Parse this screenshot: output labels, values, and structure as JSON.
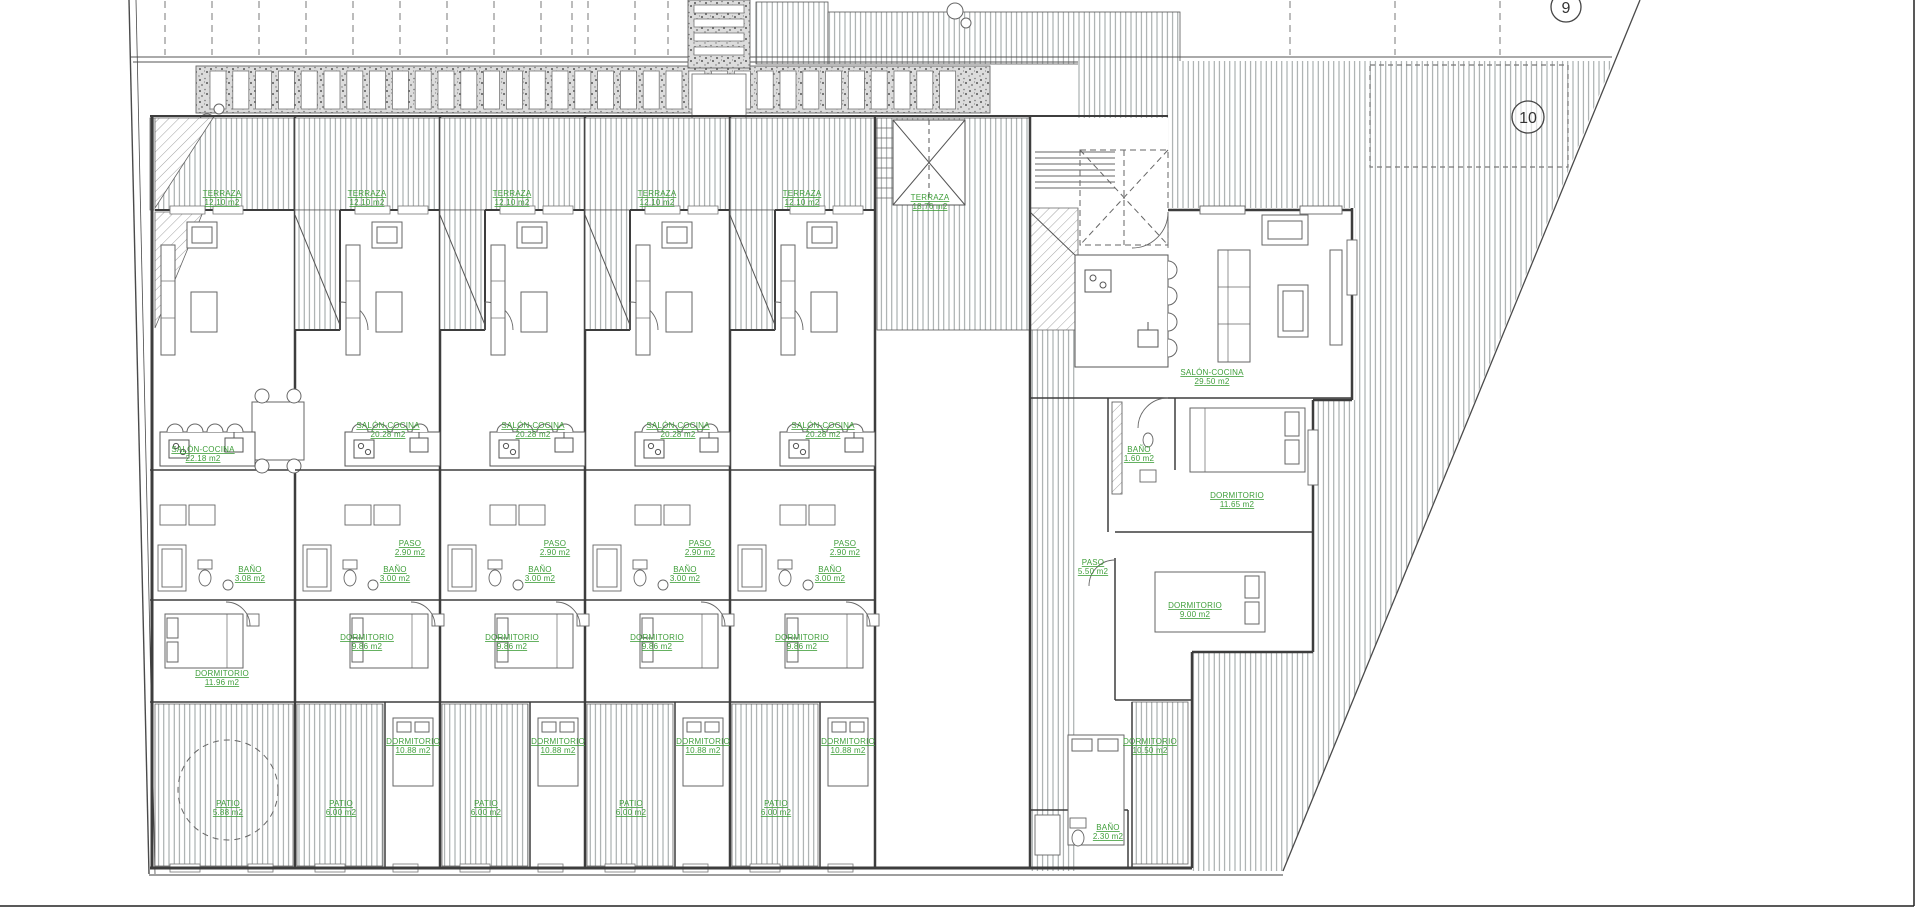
{
  "drawing": {
    "type": "architectural-floor-plan",
    "colors": {
      "label_green": "#3f9e3a",
      "line_dark": "#3d3d3d",
      "hatch_gray": "#9aa0a0"
    }
  },
  "plots": [
    {
      "number": "9"
    },
    {
      "number": "10"
    }
  ],
  "units": [
    {
      "id": "unit-1",
      "labels": {
        "terraza": {
          "name": "TERRAZA",
          "area": "12.10 m2"
        },
        "salon": {
          "name": "SALÓN-COCINA",
          "area": "22.18 m2"
        },
        "bano": {
          "name": "BAÑO",
          "area": "3.08 m2"
        },
        "dorm1": {
          "name": "DORMITORIO",
          "area": "11.96 m2"
        },
        "patio": {
          "name": "PATIO",
          "area": "5.88 m2"
        }
      }
    },
    {
      "id": "unit-2",
      "labels": {
        "terraza": {
          "name": "TERRAZA",
          "area": "12.10 m2"
        },
        "salon": {
          "name": "SALÓN-COCINA",
          "area": "20.28 m2"
        },
        "paso": {
          "name": "PASO",
          "area": "2.90 m2"
        },
        "bano": {
          "name": "BAÑO",
          "area": "3.00 m2"
        },
        "dorm1": {
          "name": "DORMITORIO",
          "area": "9.86 m2"
        },
        "dorm2": {
          "name": "DORMITORIO",
          "area": "10.88 m2"
        },
        "patio": {
          "name": "PATIO",
          "area": "6.00 m2"
        }
      }
    },
    {
      "id": "unit-3",
      "labels": {
        "terraza": {
          "name": "TERRAZA",
          "area": "12.10 m2"
        },
        "salon": {
          "name": "SALÓN-COCINA",
          "area": "20.28 m2"
        },
        "paso": {
          "name": "PASO",
          "area": "2.90 m2"
        },
        "bano": {
          "name": "BAÑO",
          "area": "3.00 m2"
        },
        "dorm1": {
          "name": "DORMITORIO",
          "area": "9.86 m2"
        },
        "dorm2": {
          "name": "DORMITORIO",
          "area": "10.88 m2"
        },
        "patio": {
          "name": "PATIO",
          "area": "6.00 m2"
        }
      }
    },
    {
      "id": "unit-4",
      "labels": {
        "terraza": {
          "name": "TERRAZA",
          "area": "12.10 m2"
        },
        "salon": {
          "name": "SALÓN-COCINA",
          "area": "20.28 m2"
        },
        "paso": {
          "name": "PASO",
          "area": "2.90 m2"
        },
        "bano": {
          "name": "BAÑO",
          "area": "3.00 m2"
        },
        "dorm1": {
          "name": "DORMITORIO",
          "area": "9.86 m2"
        },
        "dorm2": {
          "name": "DORMITORIO",
          "area": "10.88 m2"
        },
        "patio": {
          "name": "PATIO",
          "area": "6.00 m2"
        }
      }
    },
    {
      "id": "unit-5",
      "labels": {
        "terraza": {
          "name": "TERRAZA",
          "area": "12.10 m2"
        },
        "salon": {
          "name": "SALÓN-COCINA",
          "area": "20.28 m2"
        },
        "paso": {
          "name": "PASO",
          "area": "2.90 m2"
        },
        "bano": {
          "name": "BAÑO",
          "area": "3.00 m2"
        },
        "dorm1": {
          "name": "DORMITORIO",
          "area": "9.86 m2"
        },
        "dorm2": {
          "name": "DORMITORIO",
          "area": "10.88 m2"
        },
        "patio": {
          "name": "PATIO",
          "area": "6.00 m2"
        }
      }
    }
  ],
  "right_house": {
    "id": "corner-house",
    "labels": {
      "terraza": {
        "name": "TERRAZA",
        "area": "18.76 m2"
      },
      "salon": {
        "name": "SALÓN-COCINA",
        "area": "29.50 m2"
      },
      "dorm1": {
        "name": "DORMITORIO",
        "area": "11.65 m2"
      },
      "bano1": {
        "name": "BAÑO",
        "area": "1.60 m2"
      },
      "paso": {
        "name": "PASO",
        "area": "5.50 m2"
      },
      "dorm2": {
        "name": "DORMITORIO",
        "area": "9.00 m2"
      },
      "dorm3": {
        "name": "DORMITORIO",
        "area": "10.50 m2"
      },
      "bano2": {
        "name": "BAÑO",
        "area": "2.30 m2"
      }
    }
  }
}
